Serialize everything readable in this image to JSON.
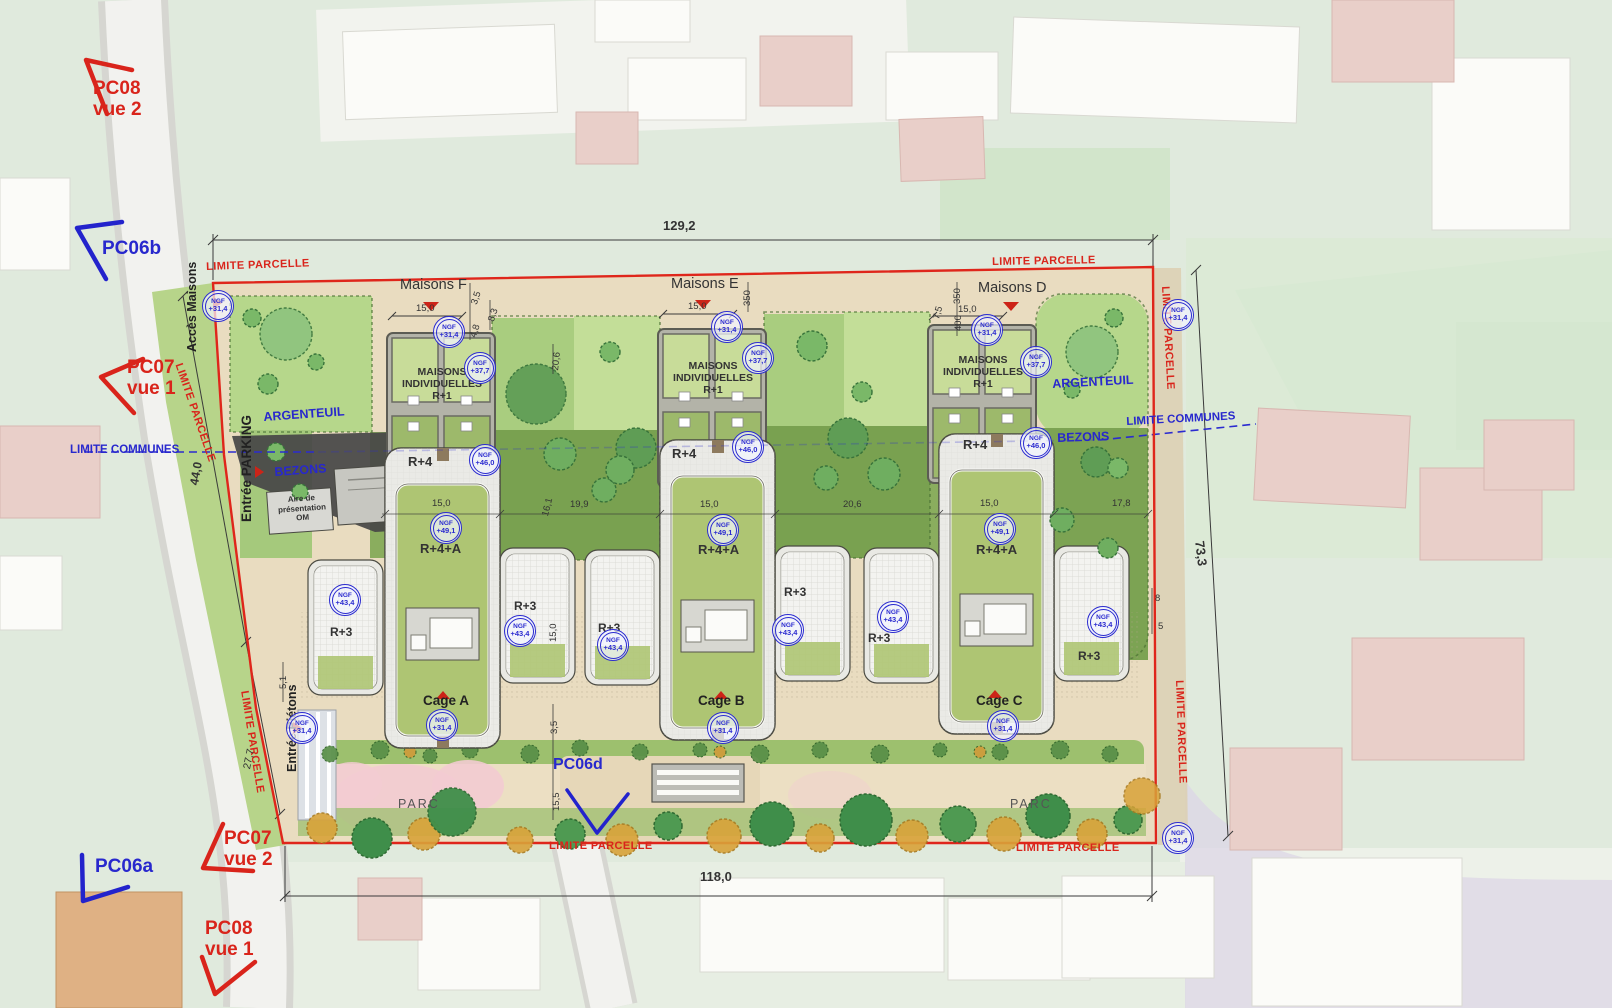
{
  "texts": {
    "limite_parcelle": "LIMITE PARCELLE",
    "limite_communes": "LIMITE COMMUNES",
    "argenteuil": "ARGENTEUIL",
    "bezons": "BEZONS",
    "acces_maisons": "Accès Maisons",
    "entree_parking": "Entrée PARKING",
    "entree_pietons": "Entrée Piétons",
    "maisons_f": "Maisons F",
    "maisons_e": "Maisons E",
    "maisons_d": "Maisons D",
    "maisons_individuelles": "MAISONS INDIVIDUELLES",
    "r1": "R+1",
    "r3": "R+3",
    "r4": "R+4",
    "r4a": "R+4+A",
    "cage_a": "Cage A",
    "cage_b": "Cage B",
    "cage_c": "Cage C",
    "parc": "PARC",
    "aire_presentation_om": "Aire de présentation OM"
  },
  "pc_views": {
    "pc08": "PC08",
    "pc07": "PC07",
    "pc06a": "PC06a",
    "pc06b": "PC06b",
    "pc06d": "PC06d",
    "vue_1": "vue 1",
    "vue_2": "vue 2"
  },
  "dimensions": {
    "top_total": "129,2",
    "right_total": "73,3",
    "bottom_total": "118,0",
    "left_upper": "44,0",
    "left_lower": "27,7",
    "d_15_0": "15,0",
    "d_3_5": "3,5",
    "d_8_3": "8,3",
    "d_4_8": "4,8",
    "d_20_6": "20,6",
    "d_16_1": "16,1",
    "d_19_9": "19,9",
    "d_17_8": "17,8",
    "d_350": "350",
    "d_400": "400",
    "d_7_5": "7,5",
    "d_15_5": "15,5",
    "d_5_1": "5,1",
    "d_8": "8",
    "d_5": "5"
  },
  "ngf": {
    "label": "NGF",
    "ground": "+31,4",
    "r1_roof": "+37,7",
    "r3_roof": "+43,4",
    "r4_roof": "+46,0",
    "r4a_roof": "+49,1"
  },
  "colors": {
    "parcel_boundary_red": "#df261b",
    "annotation_blue": "#2b2bd0",
    "site_ground": "#e9dcc0",
    "garden_light": "#b6d78b",
    "garden_dark": "#7ca353",
    "roof_green": "#aec573",
    "parc_pink": "#f3cbd2",
    "tree_orange": "#d9a339",
    "tree_green": "#4f9a52",
    "asphalt": "#474747",
    "dim_line": "#3a3a3a"
  }
}
